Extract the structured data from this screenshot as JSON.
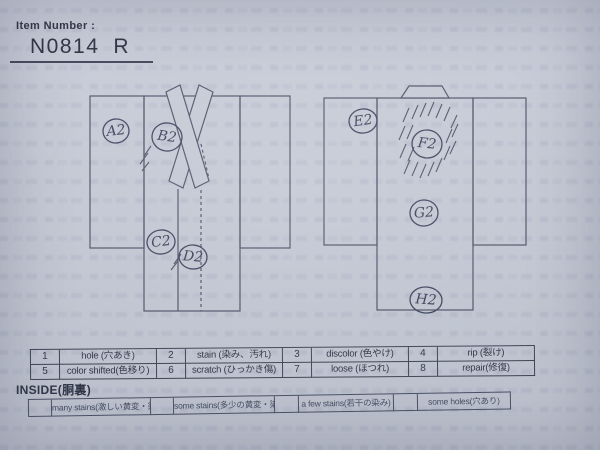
{
  "header": {
    "label": "Item Number :",
    "number": "N0814",
    "grade": "R"
  },
  "diagram": {
    "front": {
      "marks": [
        "A2",
        "B2",
        "C2",
        "D2"
      ]
    },
    "back": {
      "marks": [
        "E2",
        "F2",
        "G2",
        "H2"
      ]
    }
  },
  "legend": {
    "rows": [
      [
        {
          "num": "1",
          "label": "hole (穴あき)"
        },
        {
          "num": "2",
          "label": "stain (染み、汚れ)"
        },
        {
          "num": "3",
          "label": "discolor (色やけ)"
        },
        {
          "num": "4",
          "label": "rip (裂け)"
        }
      ],
      [
        {
          "num": "5",
          "label": "color shifted(色移り)"
        },
        {
          "num": "6",
          "label": "scratch (ひっかき傷)"
        },
        {
          "num": "7",
          "label": "loose (ほつれ)"
        },
        {
          "num": "8",
          "label": "repair(修復)"
        }
      ]
    ]
  },
  "inside": {
    "title": "INSIDE(胴裏)",
    "options": [
      "many stains(激しい黄変・染み)",
      "some stains(多少の黄変・染み)",
      "a few stains(若干の染み)",
      "some holes(穴あり)"
    ]
  },
  "colors": {
    "paper": "#cbd0db",
    "ink": "#4b5165",
    "print": "#2c3240"
  }
}
